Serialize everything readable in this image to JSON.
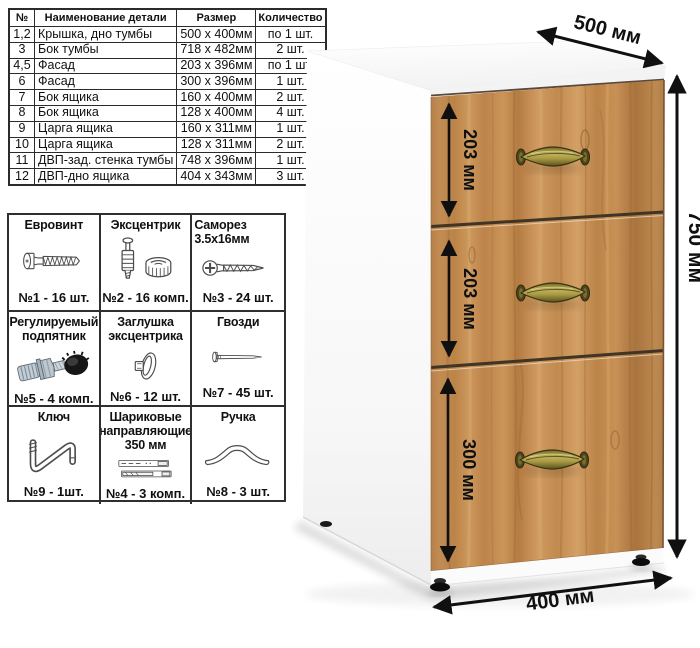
{
  "parts_table": {
    "headers": [
      "№",
      "Наименование детали",
      "Размер",
      "Количество"
    ],
    "rows": [
      [
        "1,2",
        "Крышка, дно тумбы",
        "500 х 400мм",
        "по 1 шт."
      ],
      [
        "3",
        "Бок тумбы",
        "718 х 482мм",
        "2 шт."
      ],
      [
        "4,5",
        "Фасад",
        "203 х 396мм",
        "по 1 шт."
      ],
      [
        "6",
        "Фасад",
        "300 х 396мм",
        "1 шт."
      ],
      [
        "7",
        "Бок ящика",
        "160 х 400мм",
        "2 шт."
      ],
      [
        "8",
        "Бок ящика",
        "128 х 400мм",
        "4 шт."
      ],
      [
        "9",
        "Царга ящика",
        "160 х 311мм",
        "1 шт."
      ],
      [
        "10",
        "Царга ящика",
        "128 х 311мм",
        "2 шт."
      ],
      [
        "11",
        "ДВП-зад. стенка тумбы",
        "748 х 396мм",
        "1 шт."
      ],
      [
        "12",
        "ДВП-дно ящика",
        "404 х 343мм",
        "3 шт."
      ]
    ]
  },
  "hardware": {
    "items": [
      {
        "title": "Евровинт",
        "count": "№1 - 16 шт.",
        "icon": "euro-screw-icon"
      },
      {
        "title": "Эксцентрик",
        "count": "№2 - 16 комп.",
        "icon": "cam-lock-icon"
      },
      {
        "title": "Саморез 3.5х16мм",
        "count": "№3 - 24 шт.",
        "icon": "wood-screw-icon"
      },
      {
        "title": "Регулируемый подпятник",
        "count": "№5 - 4 комп.",
        "icon": "adjustable-foot-icon"
      },
      {
        "title": "Заглушка эксцентрика",
        "count": "№6 - 12 шт.",
        "icon": "cam-cap-icon"
      },
      {
        "title": "Гвозди",
        "count": "№7 - 45 шт.",
        "icon": "nail-icon"
      },
      {
        "title": "Ключ",
        "count": "№9 - 1шт.",
        "icon": "key-icon"
      },
      {
        "title": "Шариковые направляющие 350 мм",
        "count": "№4 - 3 комп.",
        "icon": "ball-slides-icon"
      },
      {
        "title": "Ручка",
        "count": "№8 - 3 шт.",
        "icon": "handle-icon"
      }
    ]
  },
  "cabinet": {
    "dim_depth": "500 мм",
    "dim_height": "750 мм",
    "dim_width": "400 мм",
    "drawers": [
      {
        "label": "203 мм"
      },
      {
        "label": "203 мм"
      },
      {
        "label": "300 мм"
      }
    ],
    "colors": {
      "wood": "#c38c52",
      "wood_dark": "#9c6a36",
      "wood_light": "#dfb277",
      "brass": "#8a7d2f",
      "carcass": "#ffffff",
      "dim_line": "#111111"
    }
  }
}
